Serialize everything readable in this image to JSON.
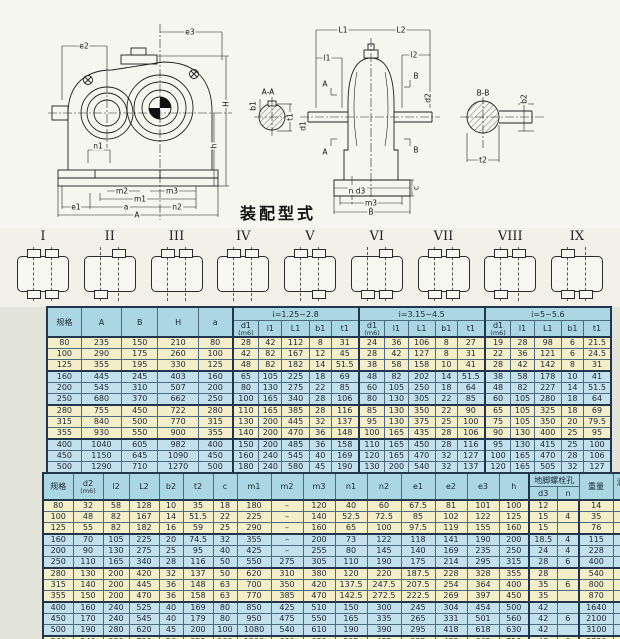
{
  "caption": "装配型式",
  "drawings": {
    "front": {
      "e2": "e2",
      "e3": "e3",
      "H": "H",
      "h": "h",
      "n1": "n1",
      "m2": "m2",
      "m3": "m3",
      "m1": "m1",
      "e1": "e1",
      "a": "a",
      "n2": "n2",
      "A": "A"
    },
    "aa": {
      "title": "A-A",
      "b1": "b1",
      "t1": "t1"
    },
    "side": {
      "L1": "L1",
      "L2": "L2",
      "l1": "l1",
      "l2": "l2",
      "A": "A",
      "B": "B",
      "d1": "d1",
      "d2": "d2",
      "c": "c",
      "nd3": "n  d3",
      "m3": "m3",
      "B_dim": "B"
    },
    "bb": {
      "title": "B-B",
      "t2": "t2",
      "b2": "b2"
    }
  },
  "assembly_types": [
    {
      "label": "I",
      "stubs": [
        "tl",
        "tr",
        "bl",
        "br"
      ]
    },
    {
      "label": "II",
      "stubs": [
        "tr",
        "bl"
      ]
    },
    {
      "label": "III",
      "stubs": [
        "tl",
        "tr"
      ]
    },
    {
      "label": "IV",
      "stubs": [
        "tl",
        "tr"
      ]
    },
    {
      "label": "V",
      "stubs": [
        "tl",
        "tr",
        "br"
      ]
    },
    {
      "label": "VI",
      "stubs": [
        "tr",
        "bl",
        "br"
      ]
    },
    {
      "label": "VII",
      "stubs": [
        "tl",
        "tr",
        "bl",
        "br"
      ]
    },
    {
      "label": "VIII",
      "stubs": [
        "tl",
        "tr",
        "bl"
      ]
    },
    {
      "label": "IX",
      "stubs": [
        "tl",
        "bl",
        "br"
      ]
    }
  ],
  "table1": {
    "header_main": [
      "规格",
      "A",
      "B",
      "H",
      "a"
    ],
    "groups": [
      "i=1.25~2.8",
      "i=3.15~4.5",
      "i=5~5.6"
    ],
    "sub_headers": [
      "d1",
      "l1",
      "L1",
      "b1",
      "t1"
    ],
    "fit_note": "(m6)",
    "rows": [
      [
        "80",
        "235",
        "150",
        "210",
        "80",
        "28",
        "42",
        "112",
        "8",
        "31",
        "24",
        "36",
        "106",
        "8",
        "27",
        "19",
        "28",
        "98",
        "6",
        "21.5"
      ],
      [
        "100",
        "290",
        "175",
        "260",
        "100",
        "42",
        "82",
        "167",
        "12",
        "45",
        "28",
        "42",
        "127",
        "8",
        "31",
        "22",
        "36",
        "121",
        "6",
        "24.5"
      ],
      [
        "125",
        "355",
        "195",
        "330",
        "125",
        "48",
        "82",
        "182",
        "14",
        "51.5",
        "38",
        "58",
        "158",
        "10",
        "41",
        "28",
        "42",
        "142",
        "8",
        "31"
      ],
      [
        "160",
        "445",
        "245",
        "403",
        "160",
        "65",
        "105",
        "225",
        "18",
        "69",
        "48",
        "82",
        "202",
        "14",
        "51.5",
        "38",
        "58",
        "178",
        "10",
        "41"
      ],
      [
        "200",
        "545",
        "310",
        "507",
        "200",
        "80",
        "130",
        "275",
        "22",
        "85",
        "60",
        "105",
        "250",
        "18",
        "64",
        "48",
        "82",
        "227",
        "14",
        "51.5"
      ],
      [
        "250",
        "680",
        "370",
        "662",
        "250",
        "100",
        "165",
        "340",
        "28",
        "106",
        "80",
        "130",
        "305",
        "22",
        "85",
        "60",
        "105",
        "280",
        "18",
        "64"
      ],
      [
        "280",
        "755",
        "450",
        "722",
        "280",
        "110",
        "165",
        "385",
        "28",
        "116",
        "85",
        "130",
        "350",
        "22",
        "90",
        "65",
        "105",
        "325",
        "18",
        "69"
      ],
      [
        "315",
        "840",
        "500",
        "770",
        "315",
        "130",
        "200",
        "445",
        "32",
        "137",
        "95",
        "130",
        "375",
        "25",
        "100",
        "75",
        "105",
        "350",
        "20",
        "79.5"
      ],
      [
        "355",
        "930",
        "550",
        "900",
        "355",
        "140",
        "200",
        "470",
        "36",
        "148",
        "100",
        "165",
        "435",
        "28",
        "106",
        "90",
        "130",
        "400",
        "25",
        "95"
      ],
      [
        "400",
        "1040",
        "605",
        "982",
        "400",
        "150",
        "200",
        "485",
        "36",
        "158",
        "110",
        "165",
        "450",
        "28",
        "116",
        "95",
        "130",
        "415",
        "25",
        "100"
      ],
      [
        "450",
        "1150",
        "645",
        "1090",
        "450",
        "160",
        "240",
        "545",
        "40",
        "169",
        "120",
        "165",
        "470",
        "32",
        "127",
        "100",
        "165",
        "470",
        "28",
        "106"
      ],
      [
        "500",
        "1290",
        "710",
        "1270",
        "500",
        "180",
        "240",
        "580",
        "45",
        "190",
        "130",
        "200",
        "540",
        "32",
        "137",
        "120",
        "165",
        "505",
        "32",
        "127"
      ],
      [
        "560",
        "1440",
        "780",
        "1360",
        "560",
        "200",
        "280",
        "660",
        "45",
        "210",
        "150",
        "200",
        "580",
        "36",
        "158",
        "130",
        "200",
        "580",
        "32",
        "137"
      ]
    ]
  },
  "table2": {
    "headers": [
      "规格",
      "d2",
      "l2",
      "L2",
      "b2",
      "t2",
      "c",
      "m1",
      "m2",
      "m3",
      "n1",
      "n2",
      "e1",
      "e2",
      "e3",
      "h"
    ],
    "fit_note": "(m6)",
    "bolt_group": {
      "label": "地脚螺栓孔",
      "subs": [
        "d3",
        "n"
      ]
    },
    "tail_headers": [
      "重量",
      "润滑油量"
    ],
    "rows": [
      [
        "80",
        "32",
        "58",
        "128",
        "10",
        "35",
        "18",
        "180",
        "–",
        "120",
        "40",
        "60",
        "67.5",
        "81",
        "101",
        "100",
        "12",
        "",
        "14",
        "0.9"
      ],
      [
        "100",
        "48",
        "82",
        "167",
        "14",
        "51.5",
        "22",
        "225",
        "–",
        "140",
        "52.5",
        "72.5",
        "85",
        "102",
        "122",
        "125",
        "15",
        "4",
        "35",
        "1.8"
      ],
      [
        "125",
        "55",
        "82",
        "182",
        "16",
        "59",
        "25",
        "290",
        "–",
        "160",
        "65",
        "100",
        "97.5",
        "119",
        "155",
        "160",
        "15",
        "",
        "76",
        "3.2"
      ],
      [
        "160",
        "70",
        "105",
        "225",
        "20",
        "74.5",
        "32",
        "355",
        "–",
        "200",
        "73",
        "122",
        "118",
        "141",
        "190",
        "200",
        "18.5",
        "4",
        "115",
        "6.5"
      ],
      [
        "200",
        "90",
        "130",
        "275",
        "25",
        "95",
        "40",
        "425",
        "–",
        "255",
        "80",
        "145",
        "140",
        "169",
        "235",
        "250",
        "24",
        "4",
        "228",
        "12.5"
      ],
      [
        "250",
        "110",
        "165",
        "340",
        "28",
        "116",
        "50",
        "550",
        "275",
        "305",
        "110",
        "190",
        "175",
        "214",
        "295",
        "315",
        "28",
        "6",
        "400",
        "23"
      ],
      [
        "280",
        "130",
        "200",
        "420",
        "32",
        "137",
        "50",
        "620",
        "310",
        "380",
        "120",
        "220",
        "187.5",
        "228",
        "328",
        "355",
        "28",
        "",
        "540",
        "36"
      ],
      [
        "315",
        "140",
        "200",
        "445",
        "36",
        "148",
        "63",
        "700",
        "350",
        "420",
        "137.5",
        "247.5",
        "207.5",
        "254",
        "364",
        "400",
        "35",
        "6",
        "800",
        "45"
      ],
      [
        "355",
        "150",
        "200",
        "470",
        "36",
        "158",
        "63",
        "770",
        "385",
        "470",
        "142.5",
        "272.5",
        "222.5",
        "269",
        "397",
        "450",
        "35",
        "",
        "870",
        "70"
      ],
      [
        "400",
        "160",
        "240",
        "525",
        "40",
        "169",
        "80",
        "850",
        "425",
        "510",
        "150",
        "300",
        "245",
        "304",
        "454",
        "500",
        "42",
        "",
        "1640",
        "90"
      ],
      [
        "450",
        "170",
        "240",
        "545",
        "40",
        "179",
        "80",
        "950",
        "475",
        "550",
        "165",
        "335",
        "265",
        "331",
        "501",
        "560",
        "42",
        "6",
        "2100",
        "125"
      ],
      [
        "500",
        "190",
        "280",
        "620",
        "45",
        "200",
        "100",
        "1080",
        "540",
        "610",
        "190",
        "390",
        "295",
        "418",
        "618",
        "630",
        "42",
        "",
        "3100",
        "180"
      ],
      [
        "560",
        "240",
        "330",
        "790",
        "56",
        "252",
        "100",
        "1200",
        "600",
        "680",
        "205",
        "435",
        "325",
        "432",
        "662",
        "710",
        "48",
        "6",
        "3730",
        "250"
      ]
    ]
  },
  "colors": {
    "header_bg": "#abd7e4",
    "band_yellow": "#f4efc9",
    "band_blue": "#c2e1ec",
    "table_border": "#23344d"
  }
}
